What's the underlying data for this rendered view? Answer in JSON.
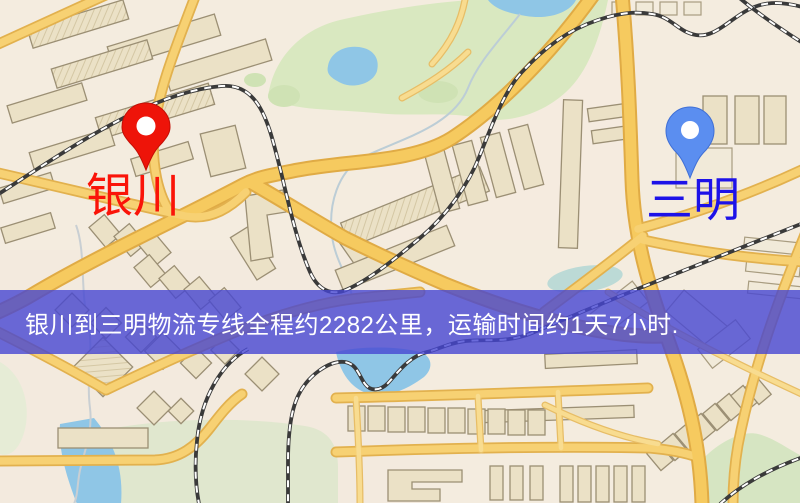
{
  "map": {
    "origin": {
      "name": "银川",
      "pin_color": "#ee1409",
      "label_color": "#fa1408"
    },
    "destination": {
      "name": "三明",
      "pin_color": "#5b8ef0",
      "label_color": "#1d12e8"
    },
    "banner": {
      "text": "银川到三明物流专线全程约2282公里，运输时间约1天7小时.",
      "distance_km": "2282",
      "duration": "1天7小时",
      "background_color": "#4646d2",
      "text_color": "#ffffff"
    },
    "palette": {
      "background": "#f4ecdf",
      "road": "#f6ca5f",
      "road_casing": "#e0ab45",
      "railway": "#3a3a3a",
      "water": "#8fc6e6",
      "park": "#d9e8c0",
      "building": "#ebe1c6"
    }
  }
}
